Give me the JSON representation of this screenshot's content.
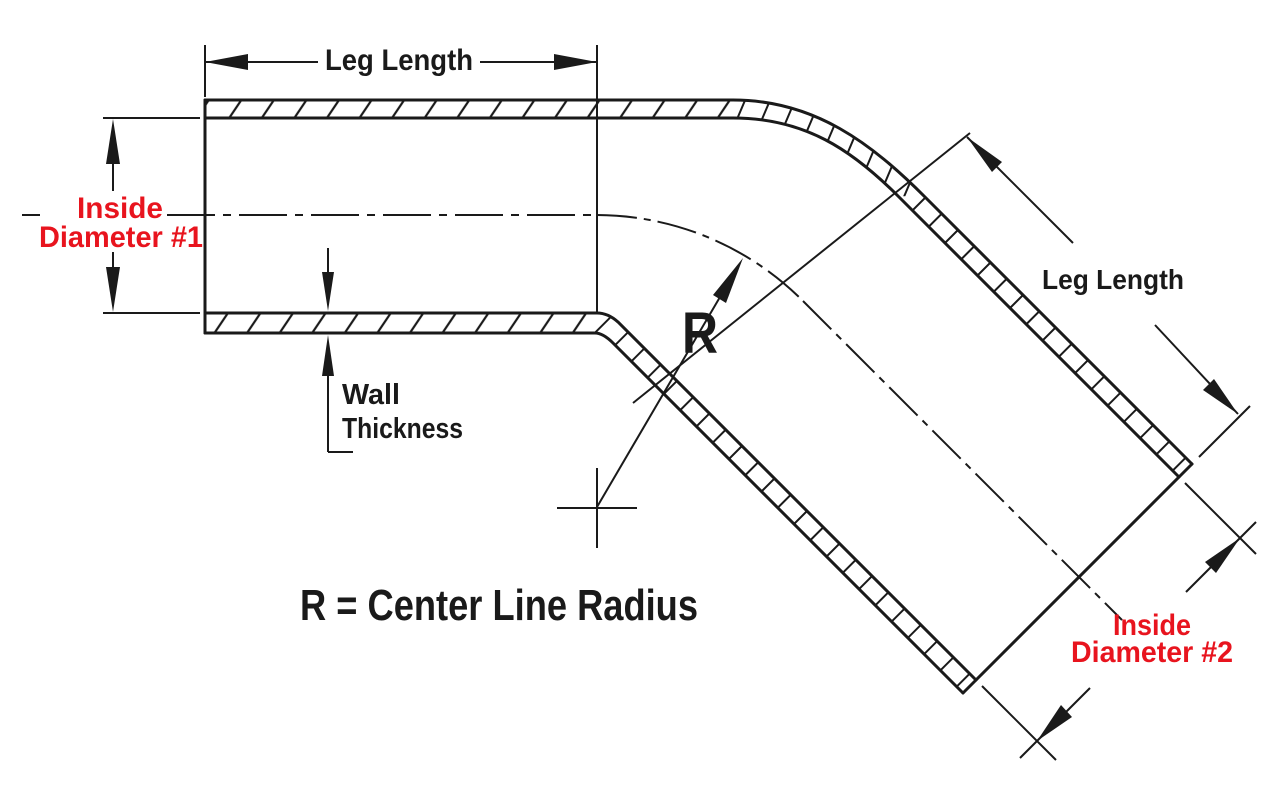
{
  "diagram": {
    "type": "technical-drawing",
    "subject": "45-degree reducer elbow tube cross-section with dimension callouts",
    "colors": {
      "background": "#ffffff",
      "line": "#1a1a1a",
      "accent_red": "#e8141e"
    },
    "labels": {
      "top_leg_length": "Leg Length",
      "diagonal_leg_length": "Leg Length",
      "inside_diameter_1_line1": "Inside",
      "inside_diameter_1_line2": "Diameter #1",
      "inside_diameter_2_line1": "Inside",
      "inside_diameter_2_line2": "Diameter #2",
      "wall_thickness_line1": "Wall",
      "wall_thickness_line2": "Thickness",
      "radius_symbol": "R",
      "radius_note": "R = Center Line Radius"
    }
  }
}
